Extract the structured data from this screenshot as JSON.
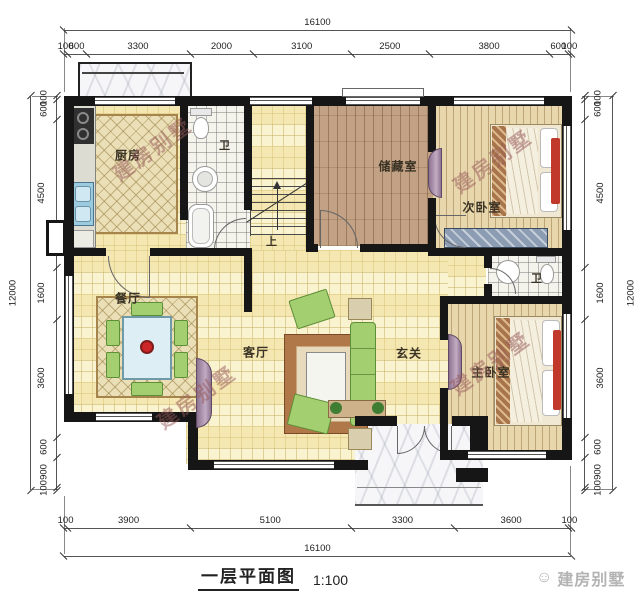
{
  "title": {
    "text": "一层平面图",
    "scale": "1:100"
  },
  "brand": {
    "logo_icon": "smiley-logo-icon",
    "name": "建房别墅"
  },
  "watermark_text": "建房别墅",
  "dimensions": {
    "top": {
      "total": "16100",
      "segments": [
        100,
        600,
        3300,
        2000,
        3100,
        2500,
        3800,
        600,
        100
      ]
    },
    "bottom": {
      "total": "16100",
      "segments": [
        100,
        3900,
        5100,
        3300,
        3600,
        100
      ]
    },
    "left": {
      "total": "12000",
      "segments": [
        100,
        600,
        4500,
        1600,
        3600,
        600,
        900,
        100
      ]
    },
    "right": {
      "total": "12000",
      "segments": [
        100,
        600,
        4500,
        1600,
        3600,
        600,
        900,
        100
      ]
    }
  },
  "rooms": {
    "kitchen": "厨房",
    "bath1": "卫",
    "storage": "储藏室",
    "bedroom2": "次卧室",
    "bath2": "卫",
    "master_bedroom": "主卧室",
    "dining": "餐厅",
    "living": "客厅",
    "foyer": "玄关",
    "stairs_up": "上"
  },
  "colors": {
    "wall": "#161616",
    "floor_tile": "#faf3cf",
    "floor_wood": "#e8d6ac",
    "floor_storage": "#c2a184",
    "accent_red": "#c0392b",
    "sofa_green": "#a3cf70",
    "door_leaf_purple": "#8d7390",
    "watermark": "#975a5a"
  }
}
